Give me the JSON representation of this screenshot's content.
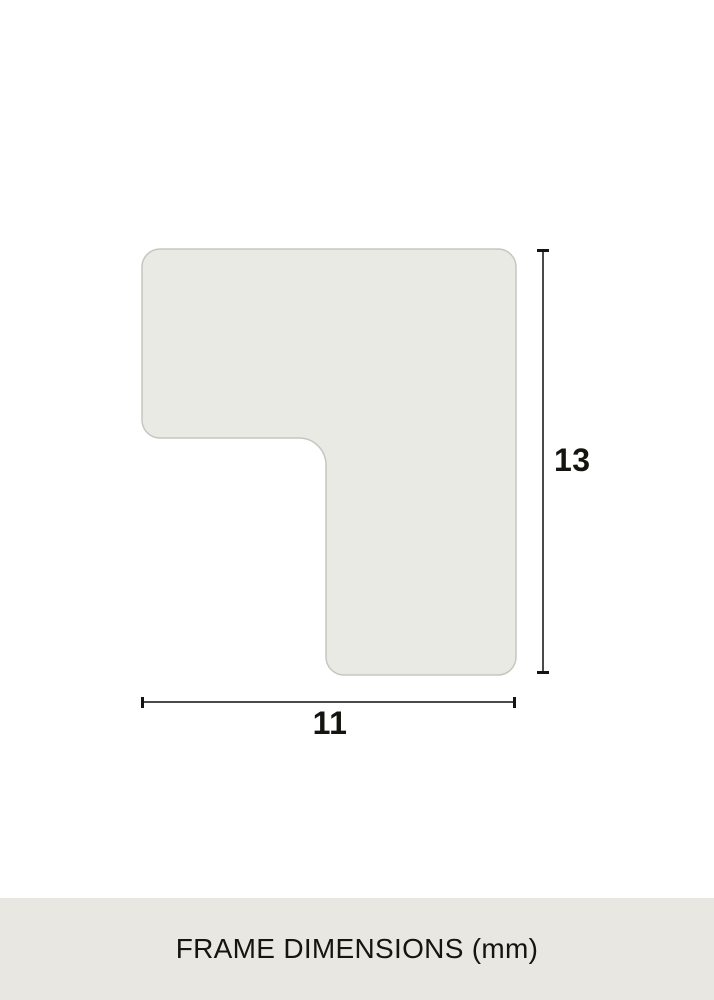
{
  "diagram": {
    "shape_name": "l-profile-cross-section",
    "height_label": "13",
    "width_label": "11"
  },
  "footer": {
    "title": "FRAME DIMENSIONS (mm)"
  },
  "colors": {
    "shape_fill": "#EAEAE5",
    "shape_border": "#C6C6C1",
    "dimension_line": "#4A4A4A",
    "tick": "#141414",
    "footer_background": "#E8E7E1",
    "text": "#15150F"
  }
}
